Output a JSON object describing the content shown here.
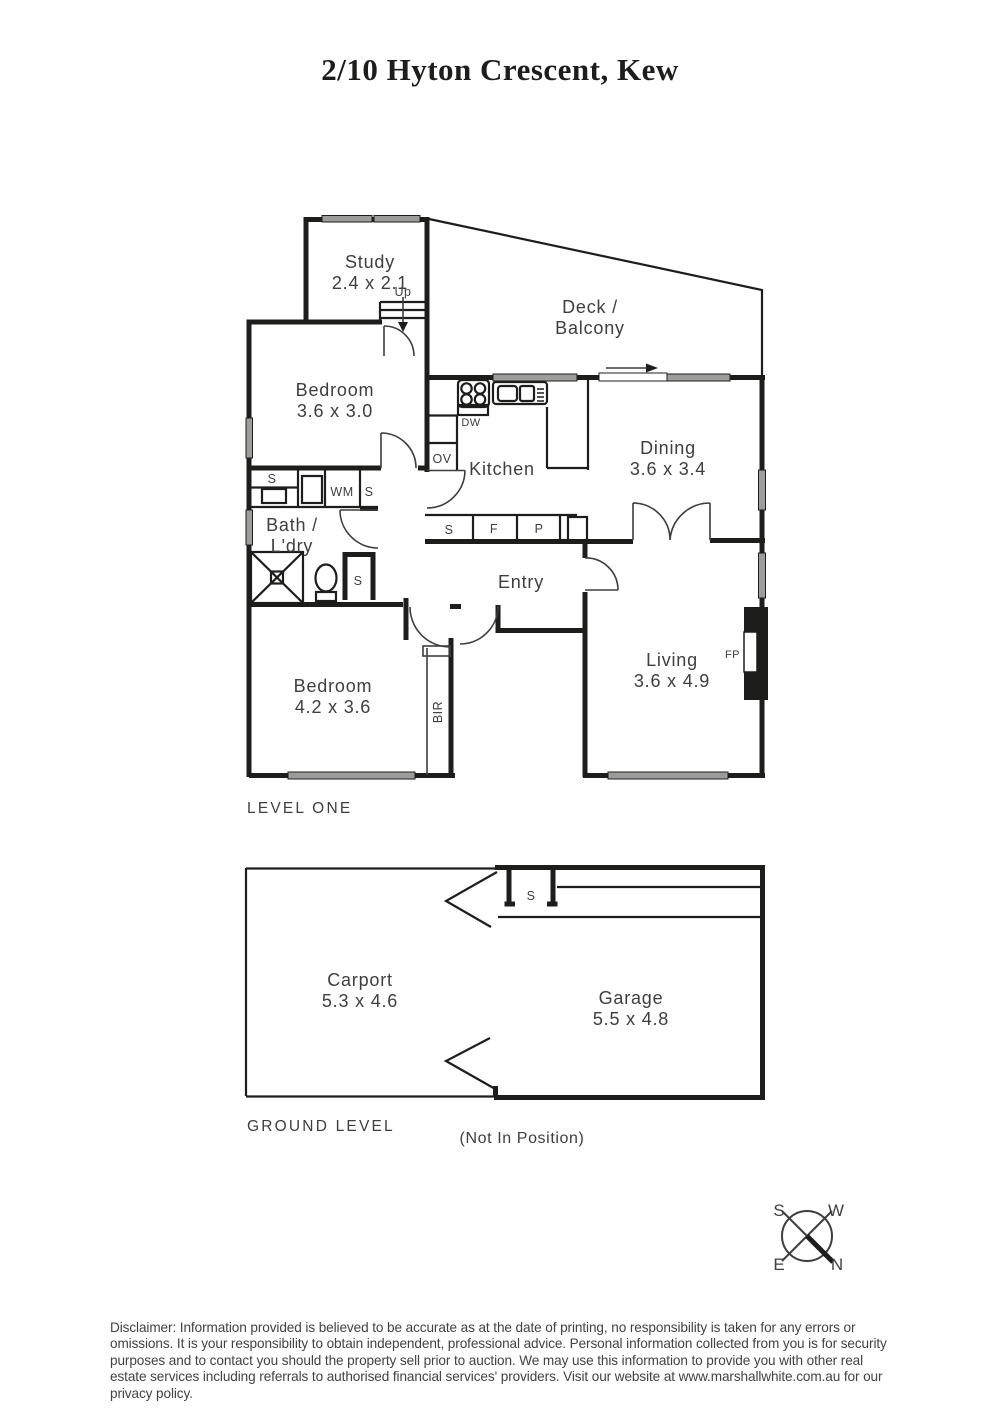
{
  "title": "2/10 Hyton Crescent, Kew",
  "levels": {
    "level_one": {
      "label": "LEVEL ONE",
      "rooms": {
        "study": {
          "name": "Study",
          "dims": "2.4 x 2.1"
        },
        "deck": {
          "name": "Deck /",
          "name2": "Balcony"
        },
        "bedroom1": {
          "name": "Bedroom",
          "dims": "3.6 x 3.0"
        },
        "kitchen": {
          "name": "Kitchen"
        },
        "dining": {
          "name": "Dining",
          "dims": "3.6 x 3.4"
        },
        "bath": {
          "name": "Bath /",
          "name2": "L'dry"
        },
        "entry": {
          "name": "Entry"
        },
        "bedroom2": {
          "name": "Bedroom",
          "dims": "4.2 x 3.6"
        },
        "living": {
          "name": "Living",
          "dims": "3.6 x 4.9"
        }
      },
      "ann": {
        "up": "Up",
        "ov": "OV",
        "dw": "DW",
        "wm": "WM",
        "s": "S",
        "f": "F",
        "p": "P",
        "fp": "FP",
        "bir": "BIR"
      }
    },
    "ground": {
      "label": "GROUND LEVEL",
      "note": "(Not In Position)",
      "rooms": {
        "carport": {
          "name": "Carport",
          "dims": "5.3 x 4.6"
        },
        "garage": {
          "name": "Garage",
          "dims": "5.5 x 4.8"
        }
      },
      "ann": {
        "s": "S"
      }
    }
  },
  "compass": {
    "n": "N",
    "s": "S",
    "e": "E",
    "w": "W"
  },
  "disclaimer": "Disclaimer: Information provided is believed to be accurate as at the date of printing, no responsibility is taken for any errors or omissions. It is your responsibility to obtain independent, professional advice. Personal information collected from you is for security purposes and to contact you should the property sell prior to auction. We may use this information to provide you with other real estate services including referrals to authorised financial services' providers. Visit our website at www.marshallwhite.com.au for our privacy policy.",
  "colors": {
    "wall": "#1d1d1b",
    "window": "#9d9d9c",
    "text": "#3e3e3d"
  }
}
